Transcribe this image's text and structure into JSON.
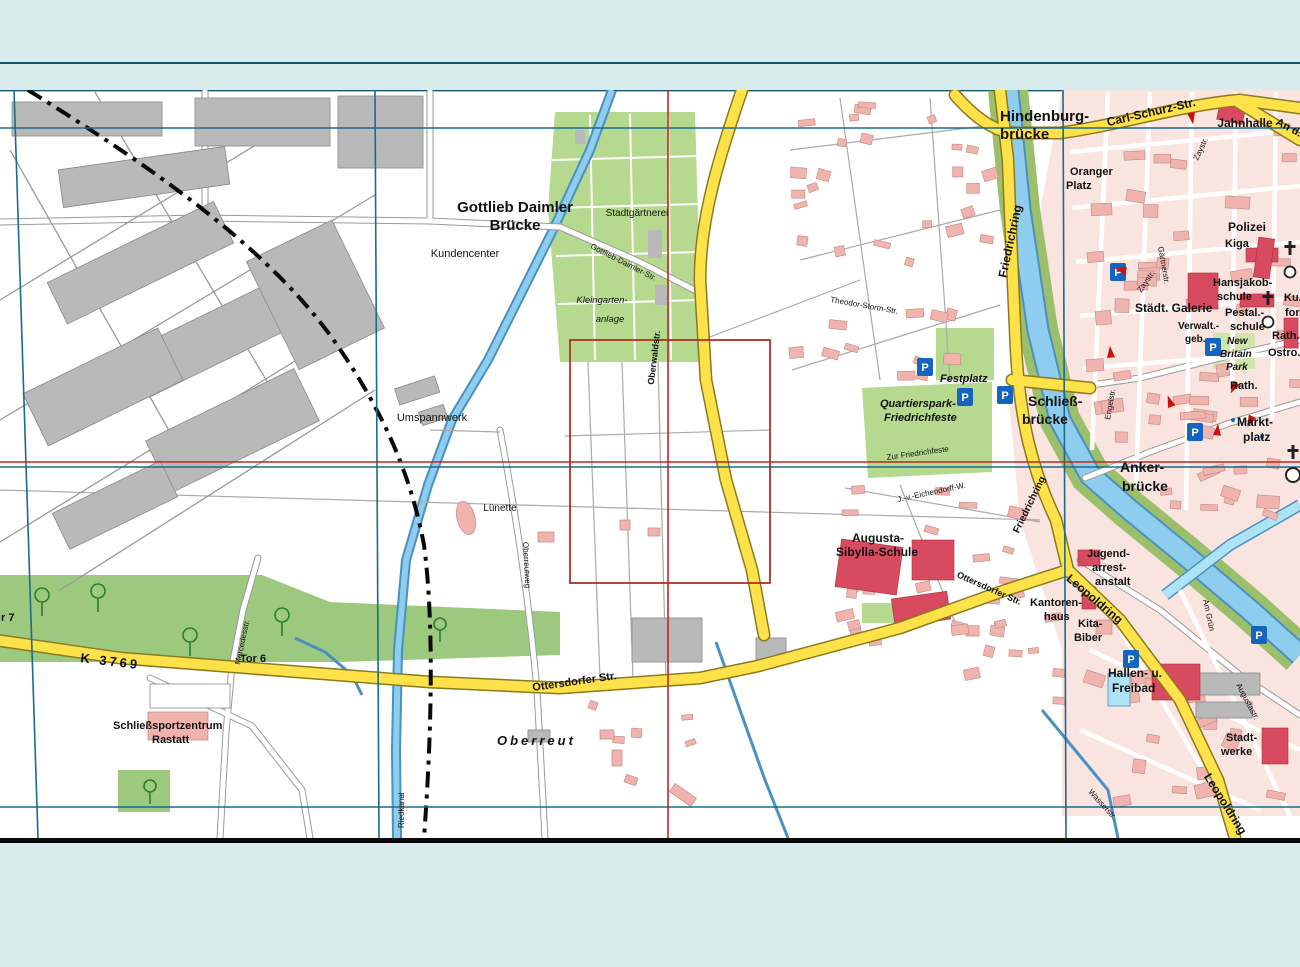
{
  "palette": {
    "page_background": "#d8ecee",
    "separator_line": "#16566e",
    "map_background": "#ffffff",
    "road_yellow": "#ffe24a",
    "road_casing": "#c9a13b",
    "water_blue": "#8fcdee",
    "water_edge": "#4a90c2",
    "river_bank_green": "#9bbf6a",
    "green_area": "#b5d98e",
    "tree_green": "#2e7d32",
    "pink_zone": "#f9e4e0",
    "pink_building": "#f0b3ae",
    "public_building": "#d84a5f",
    "gray_building": "#b9b9b9",
    "grid_blue": "#1a6b8e",
    "grid_red": "#c0281e",
    "selection_red": "#b03025",
    "parking_blue": "#1565c0",
    "arrow_red": "#cc1111",
    "boundary_black": "#0a0a0a",
    "canal_label_blue": "#2b7bbf"
  },
  "symbols": {
    "parking": "P"
  },
  "labels": {
    "hindenburg_l1": "Hindenburg-",
    "hindenburg_l2": "brücke",
    "carl_schurz": "Carl-Schurz-Str.",
    "an_d": "An d...",
    "jahnhalle": "Jahnhalle",
    "oranger_l1": "Oranger",
    "oranger_l2": "Platz",
    "polizei": "Polizei",
    "kiga": "Kiga",
    "hansjakob_l1": "Hansjakob-",
    "hansjakob_l2": "schule",
    "staedt_galerie": "Städt. Galerie",
    "pestal_l1": "Pestal.-",
    "pestal_l2": "schule",
    "verwalt_l1": "Verwalt.-",
    "verwalt_l2": "geb.",
    "new_britain_l1": "New",
    "new_britain_l2": "Britain",
    "new_britain_l3": "Park",
    "rath_1": "Rath.",
    "rath_2": "Rath.",
    "ku_partial": "Ku...",
    "for_partial": "for...",
    "ostro_partial": "Ostro...",
    "markt_l1": "Markt-",
    "markt_l2": "platz",
    "schliess_l1": "Schließ-",
    "schliess_l2": "brücke",
    "festplatz": "Festplatz",
    "quartierspark_l1": "Quartierspark-",
    "quartierspark_l2": "Friedrichfeste",
    "zur_friedrichfeste": "Zur Friedrichfeste",
    "anker_l1": "Anker-",
    "anker_l2": "brücke",
    "augusta_l1": "Augusta-",
    "augusta_l2": "Sibylla-Schule",
    "jugend_l1": "Jugend-",
    "jugend_l2": "arrest-",
    "jugend_l3": "anstalt",
    "kantoren_l1": "Kantoren-",
    "kantoren_l2": "haus",
    "kita_l1": "Kita-",
    "kita_l2": "Biber",
    "hallen_l1": "Hallen- u.",
    "hallen_l2": "Freibad",
    "stadtwerke_l1": "Stadt-",
    "stadtwerke_l2": "werke",
    "gottlieb_l1": "Gottlieb Daimler",
    "gottlieb_l2": "Brücke",
    "kundencenter": "Kundencenter",
    "stadtgaertnerei": "Stadtgärtnerei",
    "kleingarten_l1": "Kleingarten-",
    "kleingarten_l2": "anlage",
    "umspannwerk": "Umspannwerk",
    "luenette": "Lünette",
    "oberreut": "Oberreut",
    "schliesssport_l1": "Schließsportzentrum",
    "schliesssport_l2": "Rastatt",
    "tor6": "Tor 6",
    "tor7_partial": "r 7",
    "k3769": "K 3769",
    "ottersdorfer_str": "Ottersdorfer Str.",
    "friedrichring": "Friedrichring",
    "leopoldring": "Leopoldring",
    "oberwaldstr": "Oberwaldstr.",
    "gottlieb_daimler_str": "Gottlieb-Daimler-Str.",
    "oberreutweg": "Oberreutweg",
    "mercedesstr": "Mercedesstr.",
    "riedkanal": "Riedkanal",
    "zaystr": "Zaystr.",
    "wasserstr": "Wasserstr.",
    "augustastr": "Augustastr.",
    "am_gruen": "Am Grün",
    "gaertnerstr": "Gärtnerstr.",
    "engelstr": "Engelstr.",
    "theodor_storm_str": "Theodor-Storm-Str.",
    "eichendorff_w": "J.-v.-Eichendorff-W."
  }
}
